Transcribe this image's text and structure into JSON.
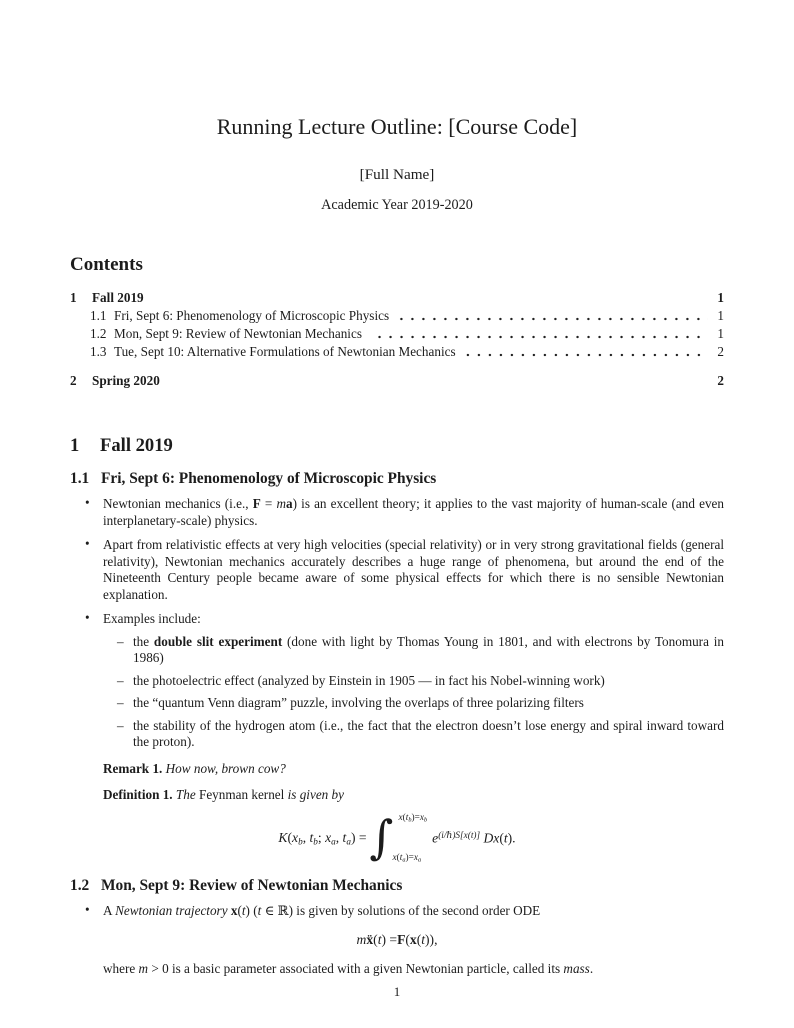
{
  "markers": {
    "bullet": "•",
    "dash": "–"
  },
  "header": {
    "title": "Running Lecture Outline: [Course Code]",
    "author": "[Full Name]",
    "date": "Academic Year 2019-2020"
  },
  "toc": {
    "heading": "Contents",
    "entries": [
      {
        "level": 1,
        "number": "1",
        "label": "Fall 2019",
        "page": "1"
      },
      {
        "level": 2,
        "number": "1.1",
        "label": "Fri, Sept 6: Phenomenology of Microscopic Physics",
        "page": "1"
      },
      {
        "level": 2,
        "number": "1.2",
        "label": "Mon, Sept 9: Review of Newtonian Mechanics",
        "page": "1"
      },
      {
        "level": 2,
        "number": "1.3",
        "label": "Tue, Sept 10: Alternative Formulations of Newtonian Mechanics",
        "page": "2"
      },
      {
        "level": 1,
        "number": "2",
        "label": "Spring 2020",
        "page": "2"
      }
    ]
  },
  "body": {
    "sec1": {
      "number": "1",
      "title": "Fall 2019"
    },
    "sub11": {
      "number": "1.1",
      "title": "Fri, Sept 6: Phenomenology of Microscopic Physics"
    },
    "bullet1": [
      {
        "t": "Newtonian mechanics (i.e., "
      },
      {
        "t": "F",
        "s": "b"
      },
      {
        "t": " = "
      },
      {
        "t": "m",
        "s": "i"
      },
      {
        "t": "a",
        "s": "b"
      },
      {
        "t": ") is an excellent theory; it applies to the vast majority of human-scale (and even interplanetary-scale) physics."
      }
    ],
    "bullet2": [
      {
        "t": "Apart from relativistic effects at very high velocities (special relativity) or in very strong gravitational fields (general relativity), Newtonian mechanics accurately describes a huge range of phenomena, but around the end of the Nineteenth Century people became aware of some physical effects for which there is no sensible Newtonian explanation."
      }
    ],
    "bullet3": [
      {
        "t": "Examples include:"
      }
    ],
    "sub_items": [
      [
        {
          "t": "the "
        },
        {
          "t": "double slit experiment",
          "s": "b"
        },
        {
          "t": " (done with light by Thomas Young in 1801, and with electrons by Tonomura in 1986)"
        }
      ],
      [
        {
          "t": "the photoelectric effect (analyzed by Einstein in 1905 — in fact his Nobel-winning work)"
        }
      ],
      [
        {
          "t": "the “quantum Venn diagram” puzzle, involving the overlaps of three polarizing filters"
        }
      ],
      [
        {
          "t": "the stability of the hydrogen atom (i.e., the fact that the electron doesn’t lose energy and spiral inward toward the proton)."
        }
      ]
    ],
    "remark": [
      {
        "t": "Remark 1.",
        "s": "b"
      },
      {
        "t": " "
      },
      {
        "t": "How now, brown cow?",
        "s": "i"
      }
    ],
    "definition": [
      {
        "t": "Definition 1.",
        "s": "b"
      },
      {
        "t": " "
      },
      {
        "t": "The ",
        "s": "i"
      },
      {
        "t": "Feynman kernel"
      },
      {
        "t": " is given by",
        "s": "i"
      }
    ],
    "feynman": {
      "lhs": [
        {
          "t": "K",
          "s": "i"
        },
        {
          "t": "("
        },
        {
          "t": "x",
          "s": "i"
        },
        {
          "t": "b",
          "s": "sub"
        },
        {
          "t": ", "
        },
        {
          "t": "t",
          "s": "i"
        },
        {
          "t": "b",
          "s": "sub"
        },
        {
          "t": "; "
        },
        {
          "t": "x",
          "s": "i"
        },
        {
          "t": "a",
          "s": "sub"
        },
        {
          "t": ", "
        },
        {
          "t": "t",
          "s": "i"
        },
        {
          "t": "a",
          "s": "sub"
        },
        {
          "t": ") = "
        }
      ],
      "integral_sign": "∫",
      "upper_limit": [
        {
          "t": "x",
          "s": "i"
        },
        {
          "t": "("
        },
        {
          "t": "t",
          "s": "i"
        },
        {
          "t": "b",
          "s": "sub"
        },
        {
          "t": ")="
        },
        {
          "t": "x",
          "s": "i"
        },
        {
          "t": "b",
          "s": "sub"
        }
      ],
      "lower_limit": [
        {
          "t": "x",
          "s": "i"
        },
        {
          "t": "("
        },
        {
          "t": "t",
          "s": "i"
        },
        {
          "t": "a",
          "s": "sub"
        },
        {
          "t": ")="
        },
        {
          "t": "x",
          "s": "i"
        },
        {
          "t": "a",
          "s": "sub"
        }
      ],
      "integrand": [
        {
          "t": "e",
          "s": "i"
        },
        {
          "t": "(i/ℏ)S[x(t)]",
          "s": "sup"
        },
        {
          "t": " "
        },
        {
          "t": "D",
          "s": "scr"
        },
        {
          "t": "x",
          "s": "i"
        },
        {
          "t": "("
        },
        {
          "t": "t",
          "s": "i"
        },
        {
          "t": ")."
        }
      ]
    },
    "sub12": {
      "number": "1.2",
      "title": "Mon, Sept 9: Review of Newtonian Mechanics"
    },
    "bullet4": [
      {
        "t": "A "
      },
      {
        "t": "Newtonian trajectory ",
        "s": "i"
      },
      {
        "t": "x",
        "s": "b"
      },
      {
        "t": "("
      },
      {
        "t": "t",
        "s": "i"
      },
      {
        "t": ") ("
      },
      {
        "t": "t",
        "s": "i"
      },
      {
        "t": " ∈ ℝ) is given by solutions of the second order ODE"
      }
    ],
    "ode": [
      {
        "t": "m",
        "s": "i"
      },
      {
        "t": " "
      },
      {
        "t": "ẍ",
        "s": "b"
      },
      {
        "t": "("
      },
      {
        "t": "t",
        "s": "i"
      },
      {
        "t": ") = "
      },
      {
        "t": "F",
        "s": "b"
      },
      {
        "t": "("
      },
      {
        "t": "x",
        "s": "b"
      },
      {
        "t": "("
      },
      {
        "t": "t",
        "s": "i"
      },
      {
        "t": ")),"
      }
    ],
    "where_line": [
      {
        "t": "where "
      },
      {
        "t": "m",
        "s": "i"
      },
      {
        "t": " > 0 is a basic parameter associated with a given Newtonian particle, called its "
      },
      {
        "t": "mass",
        "s": "i"
      },
      {
        "t": "."
      }
    ]
  },
  "footer": {
    "page_number": "1"
  }
}
